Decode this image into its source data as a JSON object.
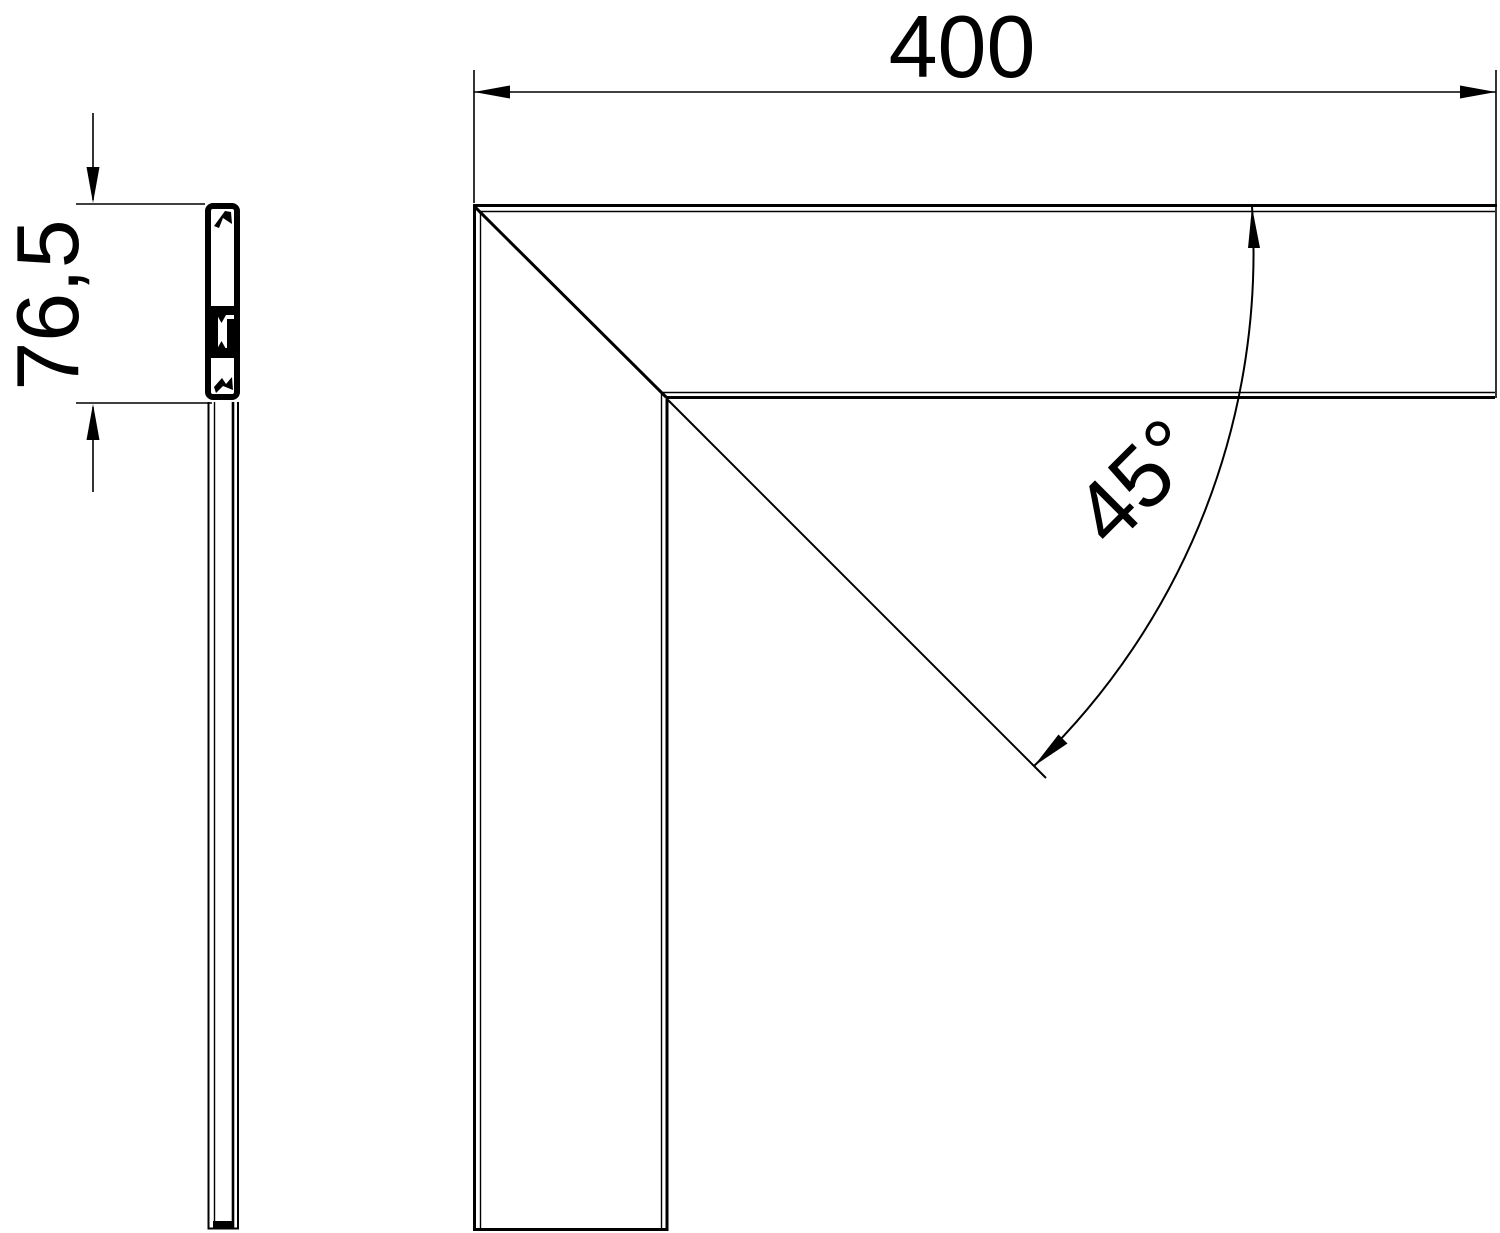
{
  "drawing": {
    "background_color": "#ffffff",
    "line_color": "#000000",
    "dimension_width_label": "400",
    "dimension_height_label": "76,5",
    "dimension_angle_label": "45°"
  }
}
